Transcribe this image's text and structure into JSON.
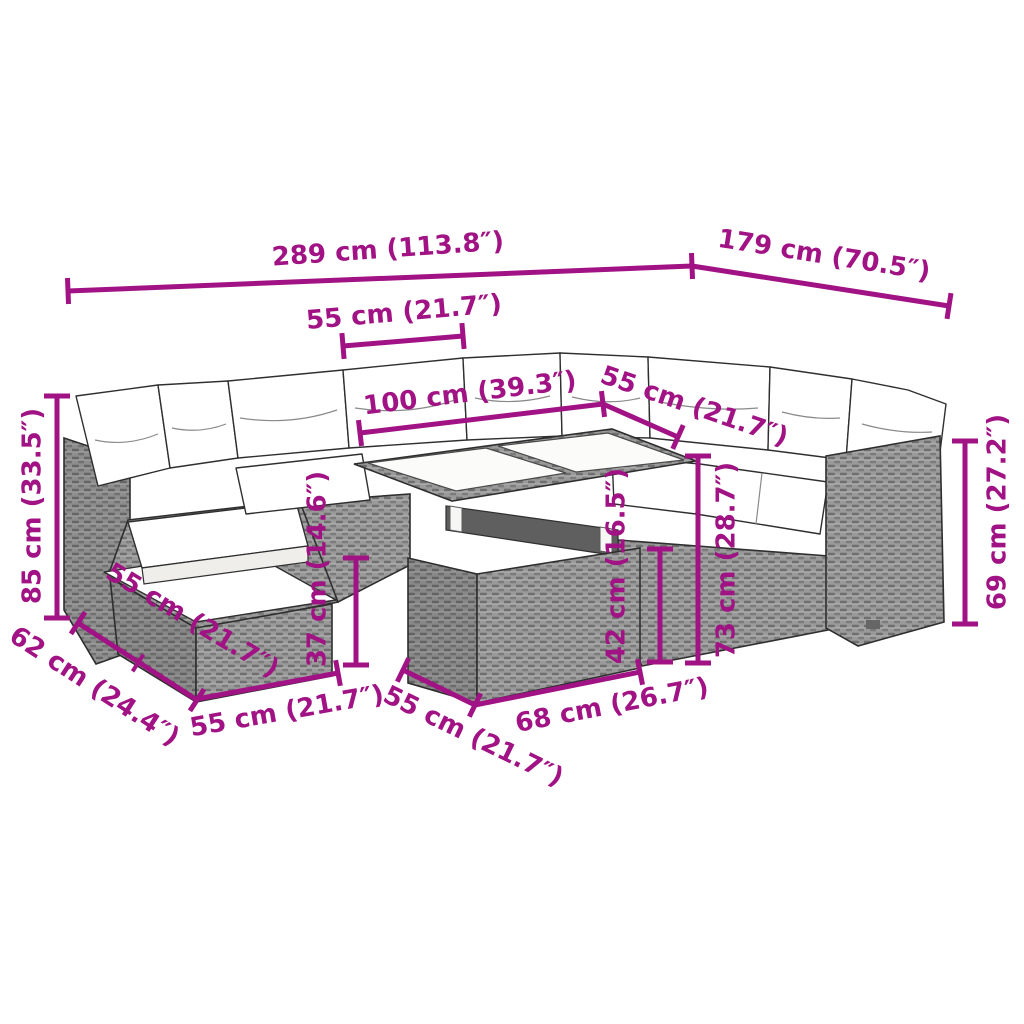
{
  "meta": {
    "image_type": "product dimension diagram",
    "subject": "garden rattan lounge sofa set with cushions, ottoman and table",
    "background_color": "#ffffff",
    "dimension_color": "#A11284",
    "furniture_outline_color": "#2f2f2f",
    "wicker_base_color": "#9a9a9a",
    "cushion_color": "#ffffff",
    "units": [
      "cm",
      "inch"
    ]
  },
  "style": {
    "line_width": 5,
    "cap_half_len": 13,
    "tick_half_len": 10,
    "font_size": 26
  },
  "dimensions": [
    {
      "name": "overall-width",
      "label": "289 cm (113.8″)",
      "cm": 289,
      "inch": 113.8,
      "line": {
        "x1": 68,
        "y1": 291,
        "x2": 692,
        "y2": 266
      },
      "cap_start": true,
      "cap_end": true,
      "ticks": [],
      "text": {
        "x": 388,
        "y": 250,
        "rotate": -4
      }
    },
    {
      "name": "overall-depth-right",
      "label": "179 cm (70.5″)",
      "cm": 179,
      "inch": 70.5,
      "line": {
        "x1": 692,
        "y1": 266,
        "x2": 949,
        "y2": 306
      },
      "cap_start": false,
      "cap_end": true,
      "ticks": [],
      "text": {
        "x": 824,
        "y": 256,
        "rotate": 9
      }
    },
    {
      "name": "back-seat-width",
      "label": "55 cm (21.7″)",
      "cm": 55,
      "inch": 21.7,
      "line": {
        "x1": 343,
        "y1": 346,
        "x2": 463,
        "y2": 336
      },
      "cap_start": true,
      "cap_end": true,
      "ticks": [],
      "text": {
        "x": 404,
        "y": 313,
        "rotate": -5
      }
    },
    {
      "name": "table-top-length",
      "label": "100 cm (39.3″)",
      "cm": 100,
      "inch": 39.3,
      "line": {
        "x1": 360,
        "y1": 433,
        "x2": 603,
        "y2": 404
      },
      "cap_start": true,
      "cap_end": true,
      "ticks": [],
      "text": {
        "x": 470,
        "y": 394,
        "rotate": -7
      }
    },
    {
      "name": "table-top-depth",
      "label": "55 cm (21.7″)",
      "cm": 55,
      "inch": 21.7,
      "line": {
        "x1": 603,
        "y1": 404,
        "x2": 678,
        "y2": 437
      },
      "cap_start": false,
      "cap_end": true,
      "ticks": [],
      "text": {
        "x": 694,
        "y": 407,
        "rotate": 19
      }
    },
    {
      "name": "back-height",
      "label": "85 cm (33.5″)",
      "cm": 85,
      "inch": 33.5,
      "line": {
        "x1": 57,
        "y1": 396,
        "x2": 57,
        "y2": 618
      },
      "cap_start": true,
      "cap_end": true,
      "ticks": [],
      "text": {
        "x": 33,
        "y": 506,
        "rotate": -90
      }
    },
    {
      "name": "corner-depth",
      "label": "62 cm (24.4″)",
      "cm": 62,
      "inch": 24.4,
      "line": {
        "x1": 78,
        "y1": 623,
        "x2": 197,
        "y2": 700
      },
      "cap_start": true,
      "cap_end": true,
      "ticks": [
        {
          "x": 138,
          "y": 663
        }
      ],
      "text": {
        "x": 94,
        "y": 687,
        "rotate": 33
      }
    },
    {
      "name": "ottoman-depth",
      "label": "55 cm (21.7″)",
      "cm": 55,
      "inch": 21.7,
      "line": null,
      "cap_start": false,
      "cap_end": false,
      "ticks": [],
      "text": {
        "x": 192,
        "y": 621,
        "rotate": 31
      }
    },
    {
      "name": "front-left-module-width",
      "label": "55 cm (21.7″)",
      "cm": 55,
      "inch": 21.7,
      "line": {
        "x1": 197,
        "y1": 699,
        "x2": 338,
        "y2": 673
      },
      "cap_start": false,
      "cap_end": true,
      "ticks": [],
      "text": {
        "x": 287,
        "y": 712,
        "rotate": -10
      }
    },
    {
      "name": "front-mid-module-width",
      "label": "55 cm (21.7″)",
      "cm": 55,
      "inch": 21.7,
      "line": {
        "x1": 403,
        "y1": 670,
        "x2": 475,
        "y2": 705
      },
      "cap_start": true,
      "cap_end": true,
      "ticks": [],
      "text": {
        "x": 473,
        "y": 737,
        "rotate": 26
      }
    },
    {
      "name": "table-bottom-width",
      "label": "68 cm (26.7″)",
      "cm": 68,
      "inch": 26.7,
      "line": {
        "x1": 475,
        "y1": 705,
        "x2": 640,
        "y2": 672
      },
      "cap_start": false,
      "cap_end": true,
      "ticks": [],
      "text": {
        "x": 612,
        "y": 706,
        "rotate": -11
      }
    },
    {
      "name": "table-base-height",
      "label": "42 cm (16.5″)",
      "cm": 42,
      "inch": 16.5,
      "line": {
        "x1": 660,
        "y1": 549,
        "x2": 660,
        "y2": 662
      },
      "cap_start": true,
      "cap_end": true,
      "ticks": [],
      "text": {
        "x": 617,
        "y": 566,
        "rotate": -90
      }
    },
    {
      "name": "ottoman-height",
      "label": "37 cm (14.6″)",
      "cm": 37,
      "inch": 14.6,
      "line": {
        "x1": 356,
        "y1": 558,
        "x2": 356,
        "y2": 665
      },
      "cap_start": true,
      "cap_end": true,
      "ticks": [],
      "text": {
        "x": 318,
        "y": 569,
        "rotate": -90
      }
    },
    {
      "name": "seat-section-height",
      "label": "73 cm (28.7″)",
      "cm": 73,
      "inch": 28.7,
      "line": {
        "x1": 698,
        "y1": 456,
        "x2": 698,
        "y2": 663
      },
      "cap_start": true,
      "cap_end": true,
      "ticks": [],
      "text": {
        "x": 727,
        "y": 560,
        "rotate": -90
      }
    },
    {
      "name": "arm-section-height",
      "label": "69 cm (27.2″)",
      "cm": 69,
      "inch": 27.2,
      "line": {
        "x1": 965,
        "y1": 441,
        "x2": 965,
        "y2": 624
      },
      "cap_start": true,
      "cap_end": true,
      "ticks": [],
      "text": {
        "x": 998,
        "y": 512,
        "rotate": -90
      }
    }
  ]
}
